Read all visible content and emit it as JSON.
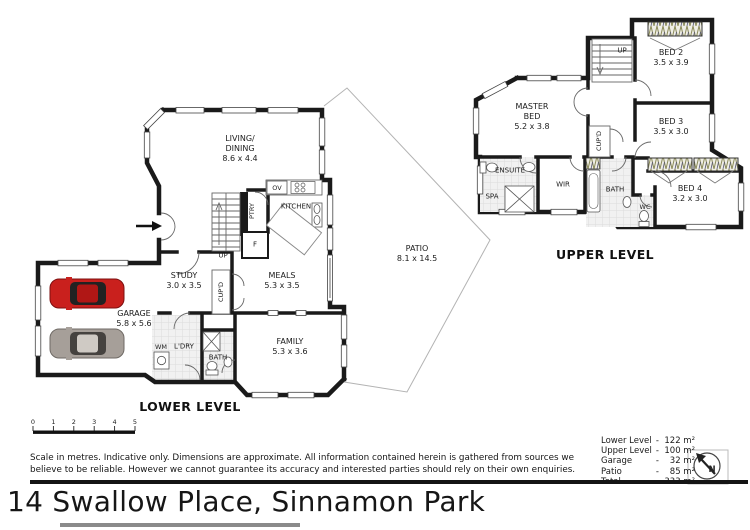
{
  "page": {
    "title": "14 Swallow Place, Sinnamon Park",
    "disclaimer": "Scale in metres. Indicative only. Dimensions are approximate.  All information contained herein is gathered from sources we\nbelieve to be reliable. However we cannot guarantee its accuracy and interested parties should rely on their own enquiries."
  },
  "scale": {
    "ticks": [
      "0",
      "1",
      "2",
      "3",
      "4",
      "5"
    ]
  },
  "compass": {
    "north_label": "N"
  },
  "levels": {
    "lower": {
      "label": "LOWER LEVEL",
      "rooms": {
        "living": {
          "name": "LIVING/\nDINING",
          "dims": "8.6 x 4.4"
        },
        "kitchen": {
          "name": "KITCHEN"
        },
        "ov": {
          "name": "OV"
        },
        "ptry": {
          "name": "PTRY"
        },
        "fridge": {
          "name": "F"
        },
        "up": {
          "name": "UP"
        },
        "study": {
          "name": "STUDY",
          "dims": "3.0 x 3.5"
        },
        "cupd": {
          "name": "CUP'D"
        },
        "meals": {
          "name": "MEALS",
          "dims": "5.3 x 3.5"
        },
        "garage": {
          "name": "GARAGE",
          "dims": "5.8 x 5.6"
        },
        "wm": {
          "name": "WM"
        },
        "ldry": {
          "name": "L'DRY"
        },
        "bath": {
          "name": "BATH"
        },
        "family": {
          "name": "FAMILY",
          "dims": "5.3 x 3.6"
        },
        "patio": {
          "name": "PATIO",
          "dims": "8.1 x 14.5"
        }
      }
    },
    "upper": {
      "label": "UPPER LEVEL",
      "rooms": {
        "up": {
          "name": "UP"
        },
        "bed2": {
          "name": "BED 2",
          "dims": "3.5 x 3.9"
        },
        "master": {
          "name": "MASTER\nBED",
          "dims": "5.2 x 3.8"
        },
        "bed3": {
          "name": "BED 3",
          "dims": "3.5 x 3.0"
        },
        "ensuite": {
          "name": "ENSUITE"
        },
        "spa": {
          "name": "SPA"
        },
        "wir": {
          "name": "WIR"
        },
        "cupd": {
          "name": "CUP'D"
        },
        "bath": {
          "name": "BATH"
        },
        "wc": {
          "name": "WC"
        },
        "bed4": {
          "name": "BED 4",
          "dims": "3.2 x 3.0"
        }
      }
    }
  },
  "areas": {
    "rows": [
      {
        "label": "Lower Level",
        "dash": "-",
        "value": "122 m²"
      },
      {
        "label": "Upper Level",
        "dash": "-",
        "value": "100 m²"
      },
      {
        "label": "Garage",
        "dash": "-",
        "value": "32 m²"
      },
      {
        "label": "Patio",
        "dash": "-",
        "value": "85 m²"
      },
      {
        "label": "Total",
        "dash": "-",
        "value": "333 m²"
      }
    ]
  },
  "colors": {
    "wall": "#1a1a1a",
    "car_red": "#c9201d",
    "car_grey": "#a69f99"
  }
}
